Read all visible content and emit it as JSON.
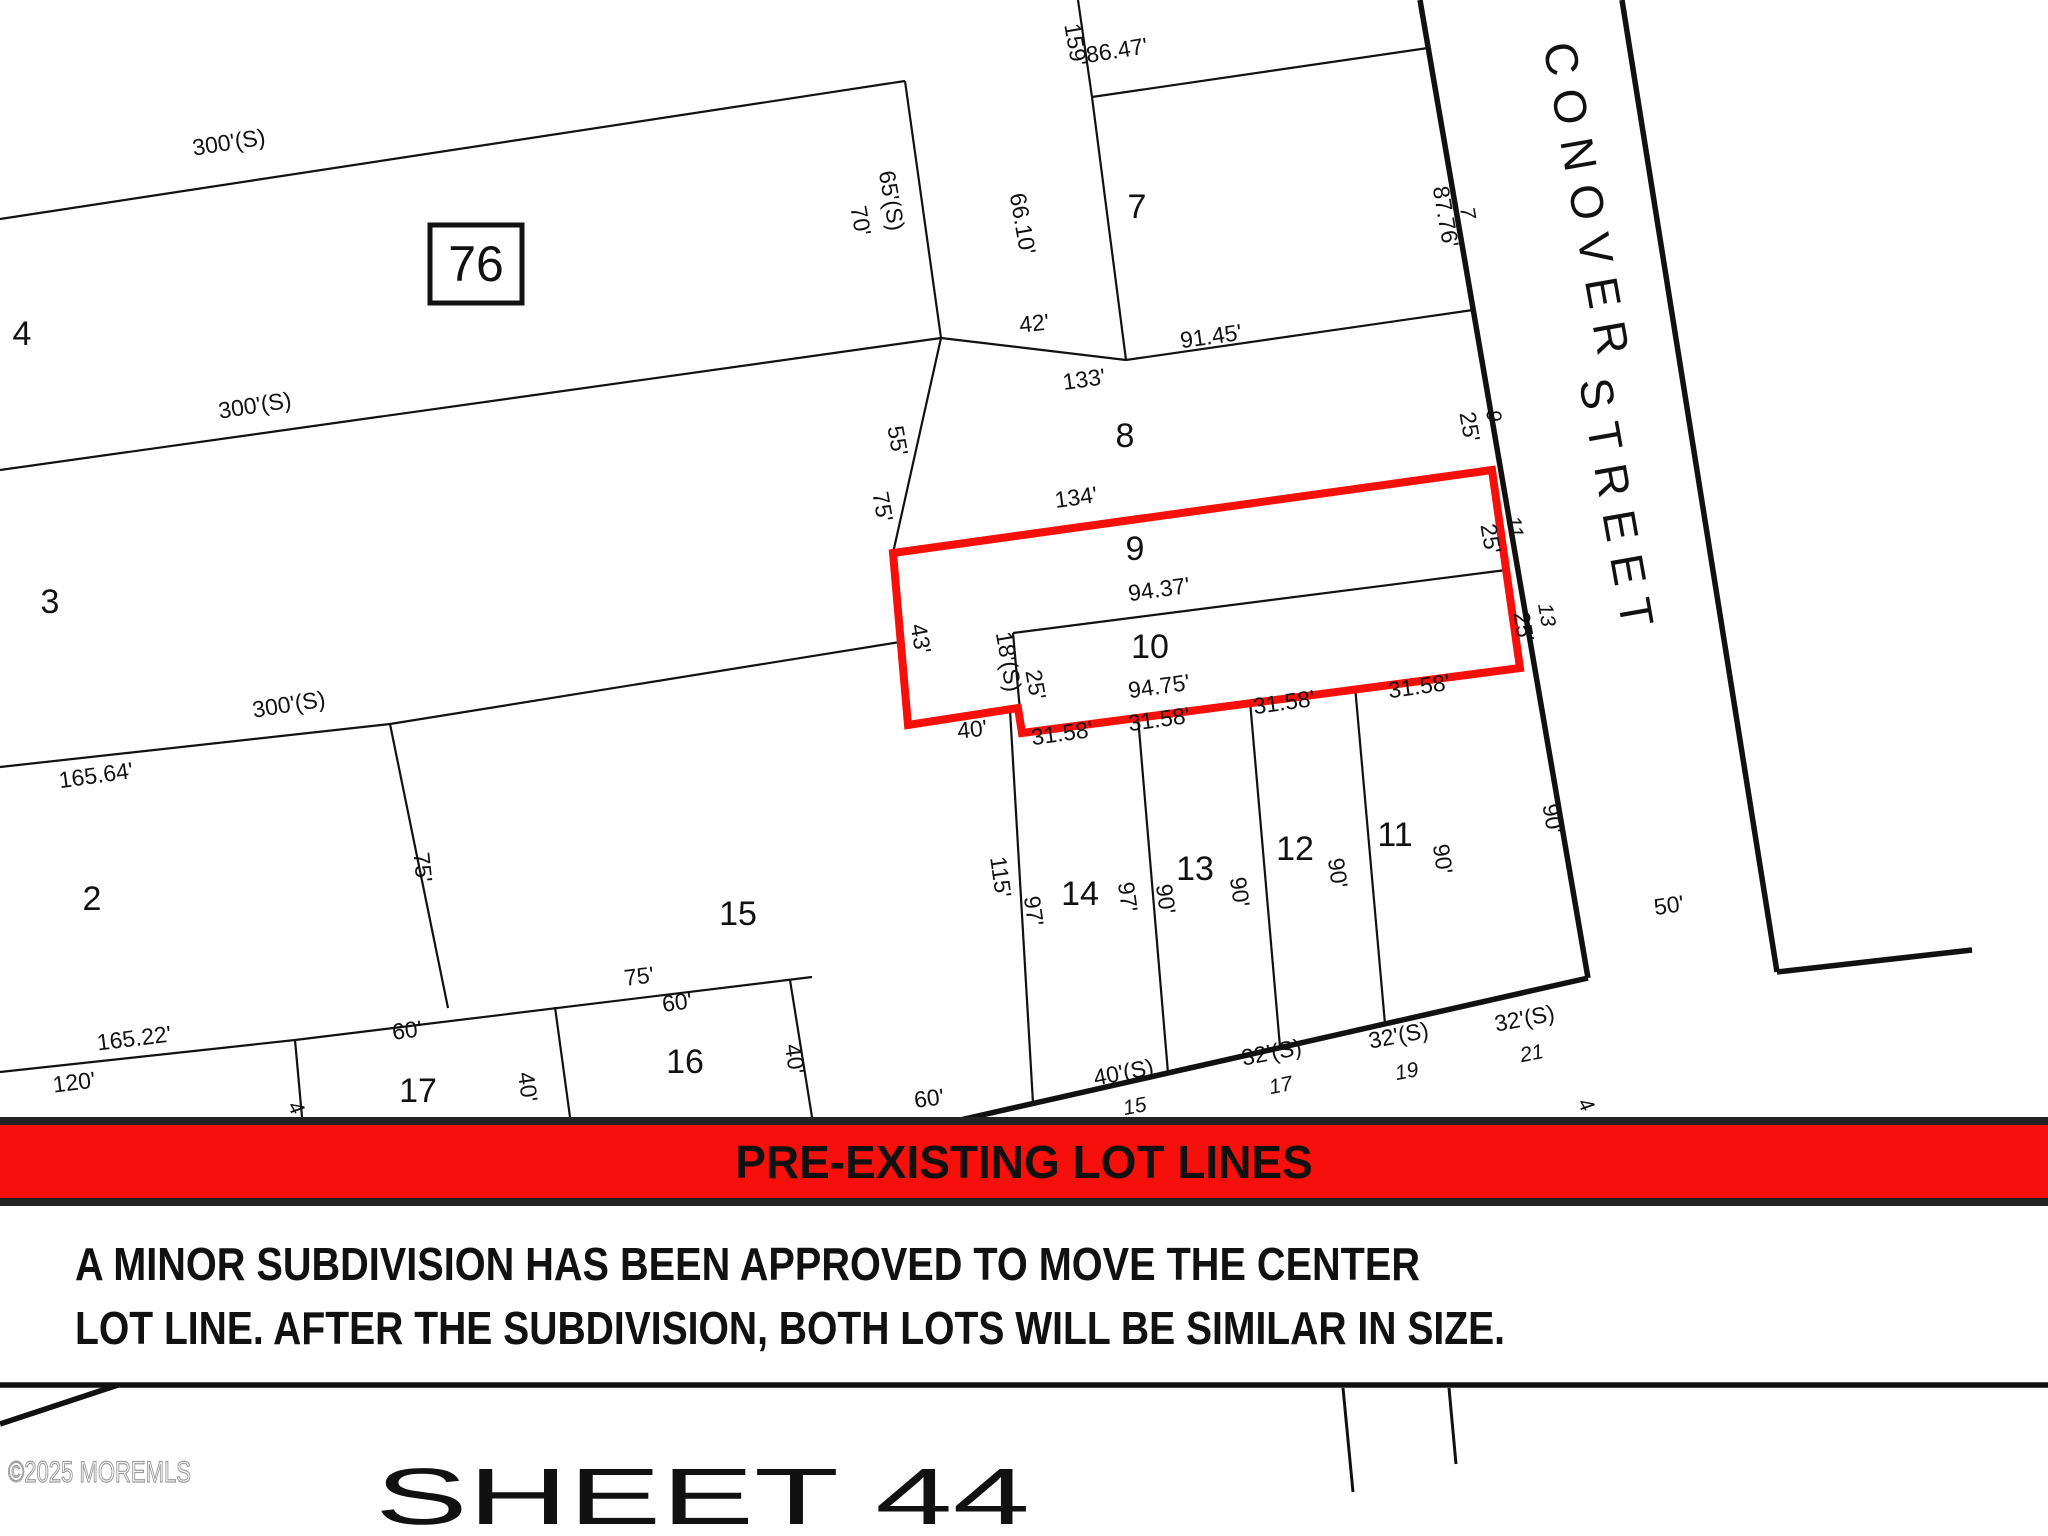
{
  "map": {
    "block_number": "76",
    "street_name_line1": "CONOVER",
    "street_name_line2": "STREET",
    "banner": {
      "text": "PRE-EXISTING LOT LINES"
    },
    "note_lines": [
      "A MINOR SUBDIVISION HAS BEEN APPROVED TO MOVE THE CENTER",
      "LOT LINE.  AFTER THE SUBDIVISION, BOTH LOTS WILL BE SIMILAR IN SIZE."
    ],
    "sheet_label": "SHEET 44",
    "watermark": "©2025 MOREMLS",
    "highlighted_lots": [
      "9",
      "10"
    ],
    "lot_numbers": [
      {
        "t": "4",
        "x": 22,
        "y": 345
      },
      {
        "t": "3",
        "x": 50,
        "y": 613
      },
      {
        "t": "2",
        "x": 92,
        "y": 910
      },
      {
        "t": "7",
        "x": 1137,
        "y": 218
      },
      {
        "t": "8",
        "x": 1125,
        "y": 447
      },
      {
        "t": "9",
        "x": 1135,
        "y": 560
      },
      {
        "t": "10",
        "x": 1150,
        "y": 658
      },
      {
        "t": "11",
        "x": 1395,
        "y": 846
      },
      {
        "t": "12",
        "x": 1295,
        "y": 860
      },
      {
        "t": "13",
        "x": 1195,
        "y": 880
      },
      {
        "t": "14",
        "x": 1080,
        "y": 905
      },
      {
        "t": "15",
        "x": 738,
        "y": 925
      },
      {
        "t": "16",
        "x": 685,
        "y": 1073
      },
      {
        "t": "17",
        "x": 418,
        "y": 1102
      }
    ],
    "dimensions": [
      {
        "t": "300'(S)",
        "x": 230,
        "y": 150,
        "r": -9
      },
      {
        "t": "300'(S)",
        "x": 256,
        "y": 413,
        "r": -9
      },
      {
        "t": "300'(S)",
        "x": 290,
        "y": 712,
        "r": -9
      },
      {
        "t": "165.64'",
        "x": 97,
        "y": 783,
        "r": -8
      },
      {
        "t": "165.22'",
        "x": 135,
        "y": 1046,
        "r": -7
      },
      {
        "t": "120'",
        "x": 75,
        "y": 1090,
        "r": -7
      },
      {
        "t": "60'",
        "x": 408,
        "y": 1038,
        "r": -7
      },
      {
        "t": "40'",
        "x": 520,
        "y": 1088,
        "r": 82
      },
      {
        "t": "75'",
        "x": 640,
        "y": 984,
        "r": -7
      },
      {
        "t": "60'",
        "x": 678,
        "y": 1010,
        "r": -7
      },
      {
        "t": "40'",
        "x": 787,
        "y": 1060,
        "r": 82
      },
      {
        "t": "60'",
        "x": 930,
        "y": 1106,
        "r": -7
      },
      {
        "t": "75'",
        "x": 415,
        "y": 868,
        "r": 84
      },
      {
        "t": "70'",
        "x": 853,
        "y": 222,
        "r": 80
      },
      {
        "t": "65'(S)",
        "x": 884,
        "y": 202,
        "r": 80
      },
      {
        "t": "159'",
        "x": 1068,
        "y": 46,
        "r": 80
      },
      {
        "t": "86.47'",
        "x": 1118,
        "y": 58,
        "r": -9
      },
      {
        "t": "66.10'",
        "x": 1015,
        "y": 225,
        "r": 80
      },
      {
        "t": "42'",
        "x": 1035,
        "y": 331,
        "r": -6
      },
      {
        "t": "133'",
        "x": 1085,
        "y": 387,
        "r": -8
      },
      {
        "t": "91.45'",
        "x": 1212,
        "y": 344,
        "r": -8
      },
      {
        "t": "87.76'",
        "x": 1438,
        "y": 218,
        "r": 80
      },
      {
        "t": "55'",
        "x": 890,
        "y": 442,
        "r": 80
      },
      {
        "t": "75'",
        "x": 875,
        "y": 508,
        "r": 80
      },
      {
        "t": "134'",
        "x": 1077,
        "y": 505,
        "r": -8
      },
      {
        "t": "94.37'",
        "x": 1160,
        "y": 597,
        "r": -8
      },
      {
        "t": "94.75'",
        "x": 1160,
        "y": 694,
        "r": -8
      },
      {
        "t": "43'",
        "x": 913,
        "y": 640,
        "r": 80
      },
      {
        "t": "18'(S)",
        "x": 1001,
        "y": 663,
        "r": 80
      },
      {
        "t": "25'",
        "x": 1028,
        "y": 686,
        "r": 80
      },
      {
        "t": "40'",
        "x": 973,
        "y": 737,
        "r": -6
      },
      {
        "t": "31.58'",
        "x": 1063,
        "y": 741,
        "r": -8
      },
      {
        "t": "31.58'",
        "x": 1160,
        "y": 727,
        "r": -8
      },
      {
        "t": "31.58'",
        "x": 1285,
        "y": 710,
        "r": -8
      },
      {
        "t": "31.58'",
        "x": 1420,
        "y": 694,
        "r": -8
      },
      {
        "t": "115'",
        "x": 993,
        "y": 878,
        "r": 82
      },
      {
        "t": "97'",
        "x": 1026,
        "y": 912,
        "r": 82
      },
      {
        "t": "97'",
        "x": 1120,
        "y": 898,
        "r": 82
      },
      {
        "t": "90'",
        "x": 1158,
        "y": 900,
        "r": 82
      },
      {
        "t": "90'",
        "x": 1232,
        "y": 893,
        "r": 82
      },
      {
        "t": "90'",
        "x": 1330,
        "y": 874,
        "r": 82
      },
      {
        "t": "90'",
        "x": 1435,
        "y": 860,
        "r": 82
      },
      {
        "t": "90'",
        "x": 1545,
        "y": 820,
        "r": 80
      },
      {
        "t": "25'",
        "x": 1462,
        "y": 428,
        "r": 80
      },
      {
        "t": "25'",
        "x": 1483,
        "y": 540,
        "r": 80
      },
      {
        "t": "25'",
        "x": 1516,
        "y": 628,
        "r": 80
      },
      {
        "t": "40'(S)",
        "x": 1125,
        "y": 1080,
        "r": -11
      },
      {
        "t": "32'(S)",
        "x": 1273,
        "y": 1060,
        "r": -11
      },
      {
        "t": "32'(S)",
        "x": 1400,
        "y": 1043,
        "r": -11
      },
      {
        "t": "32'(S)",
        "x": 1526,
        "y": 1026,
        "r": -11
      },
      {
        "t": "50'",
        "x": 1670,
        "y": 913,
        "r": -8
      }
    ],
    "street_numbers": [
      {
        "t": "7",
        "x": 1461,
        "y": 214,
        "r": 80
      },
      {
        "t": "9",
        "x": 1487,
        "y": 417,
        "r": 80
      },
      {
        "t": "11",
        "x": 1508,
        "y": 528,
        "r": 80
      },
      {
        "t": "13",
        "x": 1540,
        "y": 616,
        "r": 80
      },
      {
        "t": "15",
        "x": 1136,
        "y": 1113,
        "r": -11
      },
      {
        "t": "17",
        "x": 1282,
        "y": 1092,
        "r": -11
      },
      {
        "t": "19",
        "x": 1408,
        "y": 1078,
        "r": -11
      },
      {
        "t": "21",
        "x": 1533,
        "y": 1060,
        "r": -11
      },
      {
        "t": "4",
        "x": 1580,
        "y": 1108,
        "r": 60
      },
      {
        "t": "4",
        "x": 290,
        "y": 1111,
        "r": 60
      }
    ]
  },
  "colors": {
    "highlight": "#f60f0b",
    "banner_bg": "#f60f0b",
    "banner_border": "#222222",
    "banner_fg": "#ffffff"
  }
}
